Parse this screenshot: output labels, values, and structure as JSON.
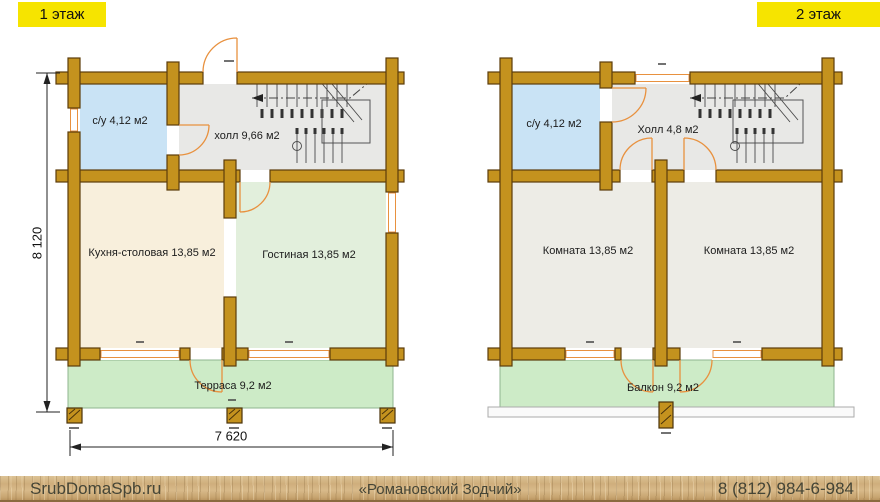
{
  "floor_tags": {
    "floor1": "1 этаж",
    "floor2": "2 этаж"
  },
  "floor1": {
    "bathroom": "с/у 4,12 м2",
    "hall": "холл 9,66 м2",
    "kitchen": "Кухня-столовая 13,85 м2",
    "living": "Гостиная 13,85 м2",
    "terrace": "Терраса 9,2 м2",
    "dim_width": "7 620",
    "dim_height": "8 120"
  },
  "floor2": {
    "bathroom": "с/у 4,12 м2",
    "hall": "Холл 4,8 м2",
    "room_left": "Комната 13,85 м2",
    "room_right": "Комната 13,85 м2",
    "balcony": "Балкон 9,2 м2"
  },
  "footer": {
    "website": "SrubDomaSpb.ru",
    "company": "«Романовский Зодчий»",
    "phone": "8 (812) 984-6-984"
  },
  "colors": {
    "log_wall": "#C4921E",
    "wall_outline": "#5C3D0B",
    "bathroom_fill": "#C9E3F5",
    "hall_fill": "#E8E8E6",
    "kitchen_fill": "#F8EFDC",
    "living_fill": "#E2EFDC",
    "terrace_fill": "#CDEBC7",
    "room_fill": "#EDECE6",
    "door_swing": "#E8913F",
    "floor_tag_bg": "#F6E400"
  }
}
